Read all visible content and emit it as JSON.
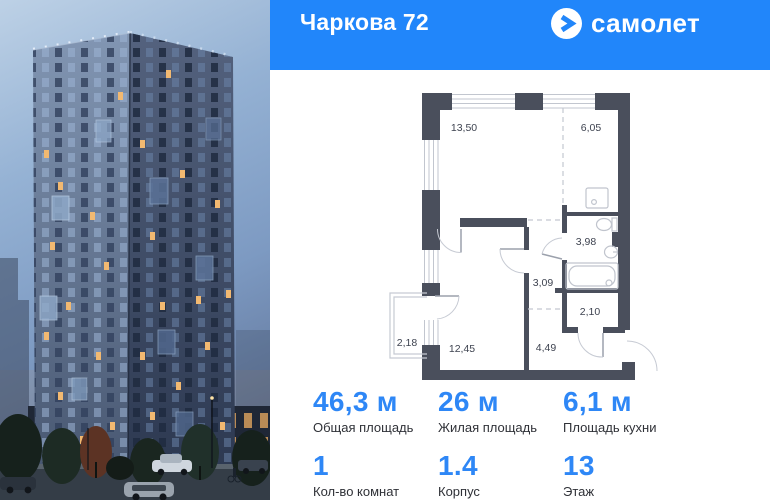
{
  "header": {
    "title": "Чаркова 72",
    "brand": "самолет"
  },
  "floor_plan": {
    "rooms": [
      {
        "id": "living",
        "area": "13,50"
      },
      {
        "id": "kitchen",
        "area": "6,05"
      },
      {
        "id": "bathroom",
        "area": "3,98"
      },
      {
        "id": "hall",
        "area": "3,09"
      },
      {
        "id": "wardrobe",
        "area": "2,10"
      },
      {
        "id": "balcony",
        "area": "2,18"
      },
      {
        "id": "bedroom",
        "area": "12,45"
      },
      {
        "id": "hallway",
        "area": "4,49"
      }
    ]
  },
  "stats": {
    "cells": [
      {
        "value": "46,3 м",
        "label": "Общая площадь"
      },
      {
        "value": "26 м",
        "label": "Жилая площадь"
      },
      {
        "value": "6,1 м",
        "label": "Площадь кухни"
      },
      {
        "value": "1",
        "label": "Кол-во комнат"
      },
      {
        "value": "1.4",
        "label": "Корпус"
      },
      {
        "value": "13",
        "label": "Этаж"
      }
    ]
  },
  "colors": {
    "accent": "#2186fa",
    "wall": "#4a4f5c",
    "lit_window": "#f0b568"
  }
}
